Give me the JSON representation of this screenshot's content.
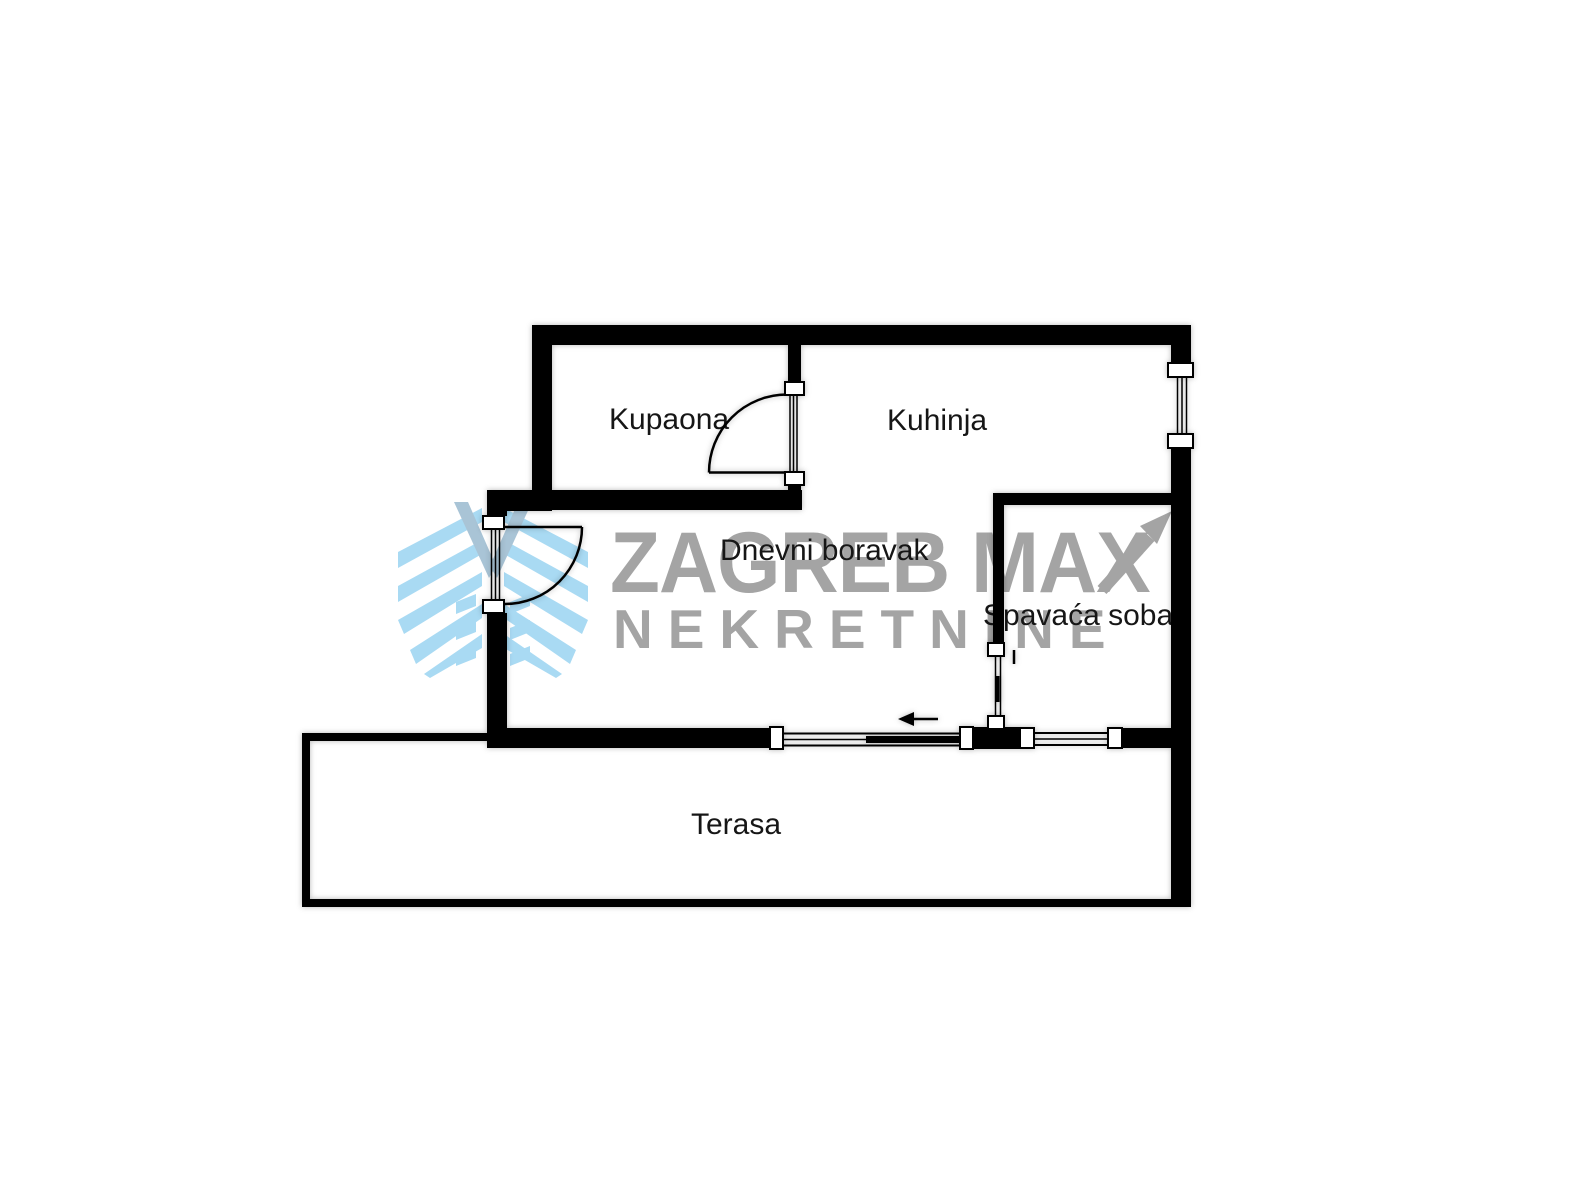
{
  "title": "Apartment floor plan",
  "watermark": {
    "line1": "ZAGREB MAX",
    "line2": "NEKRETNINE",
    "text_color": "#a4a4a4",
    "logo_blue": "#a9daf3",
    "logo_accent": "#a9c4d6"
  },
  "rooms": {
    "kupaona": {
      "label": "Kupaona"
    },
    "kuhinja": {
      "label": "Kuhinja"
    },
    "dnevni_boravak": {
      "label": "Dnevni boravak"
    },
    "spavaca_soba": {
      "label": "Spavaća soba"
    },
    "terasa": {
      "label": "Terasa"
    }
  },
  "colors": {
    "wall": "#000000",
    "background": "#ffffff",
    "label": "#161616"
  }
}
